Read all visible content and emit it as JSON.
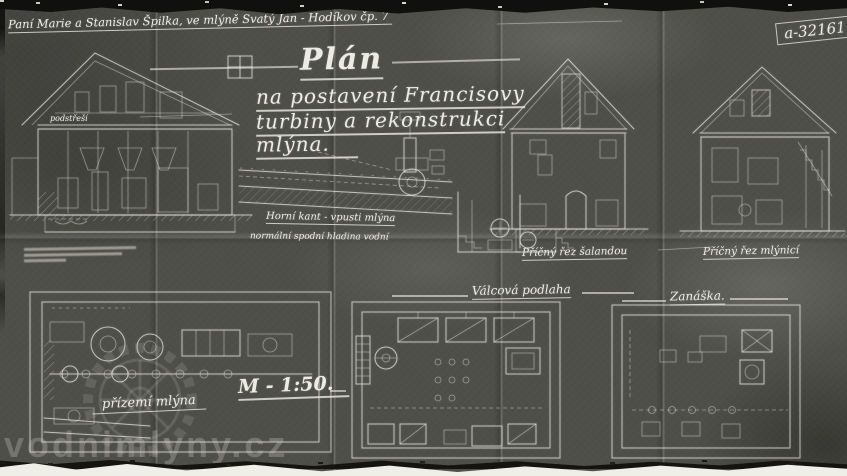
{
  "document": {
    "owner_line": "Paní Marie a Stanislav Špilka, ve mlýně Svatý Jan - Hodíkov čp. 7",
    "plan_number": "a-32161.",
    "title": {
      "line1": "Plán",
      "line2": "na postavení Francisovy",
      "line3": "turbiny a rekonstrukci",
      "line4": "mlýna."
    },
    "scale_label": "M - 1:50.",
    "annotations": {
      "upper_weir_line": "Horní kant - vpusti mlýna",
      "water_level_line": "normální spodní hladina vodní",
      "attic_label": "podstřeší",
      "section_salanda": "Příčný řez šalandou",
      "section_mlynice": "Příčný řez mlýnicí",
      "floor_ground": "přízemí mlýna",
      "floor_rollers": "Válcová podlaha",
      "floor_zanaska": "Zanáška."
    },
    "watermark": "vodnimlyny.cz",
    "colors": {
      "paper": "#4f4f49",
      "ink": "#e9e9df",
      "tear": "#10100e",
      "backing": "#efeee7"
    }
  }
}
